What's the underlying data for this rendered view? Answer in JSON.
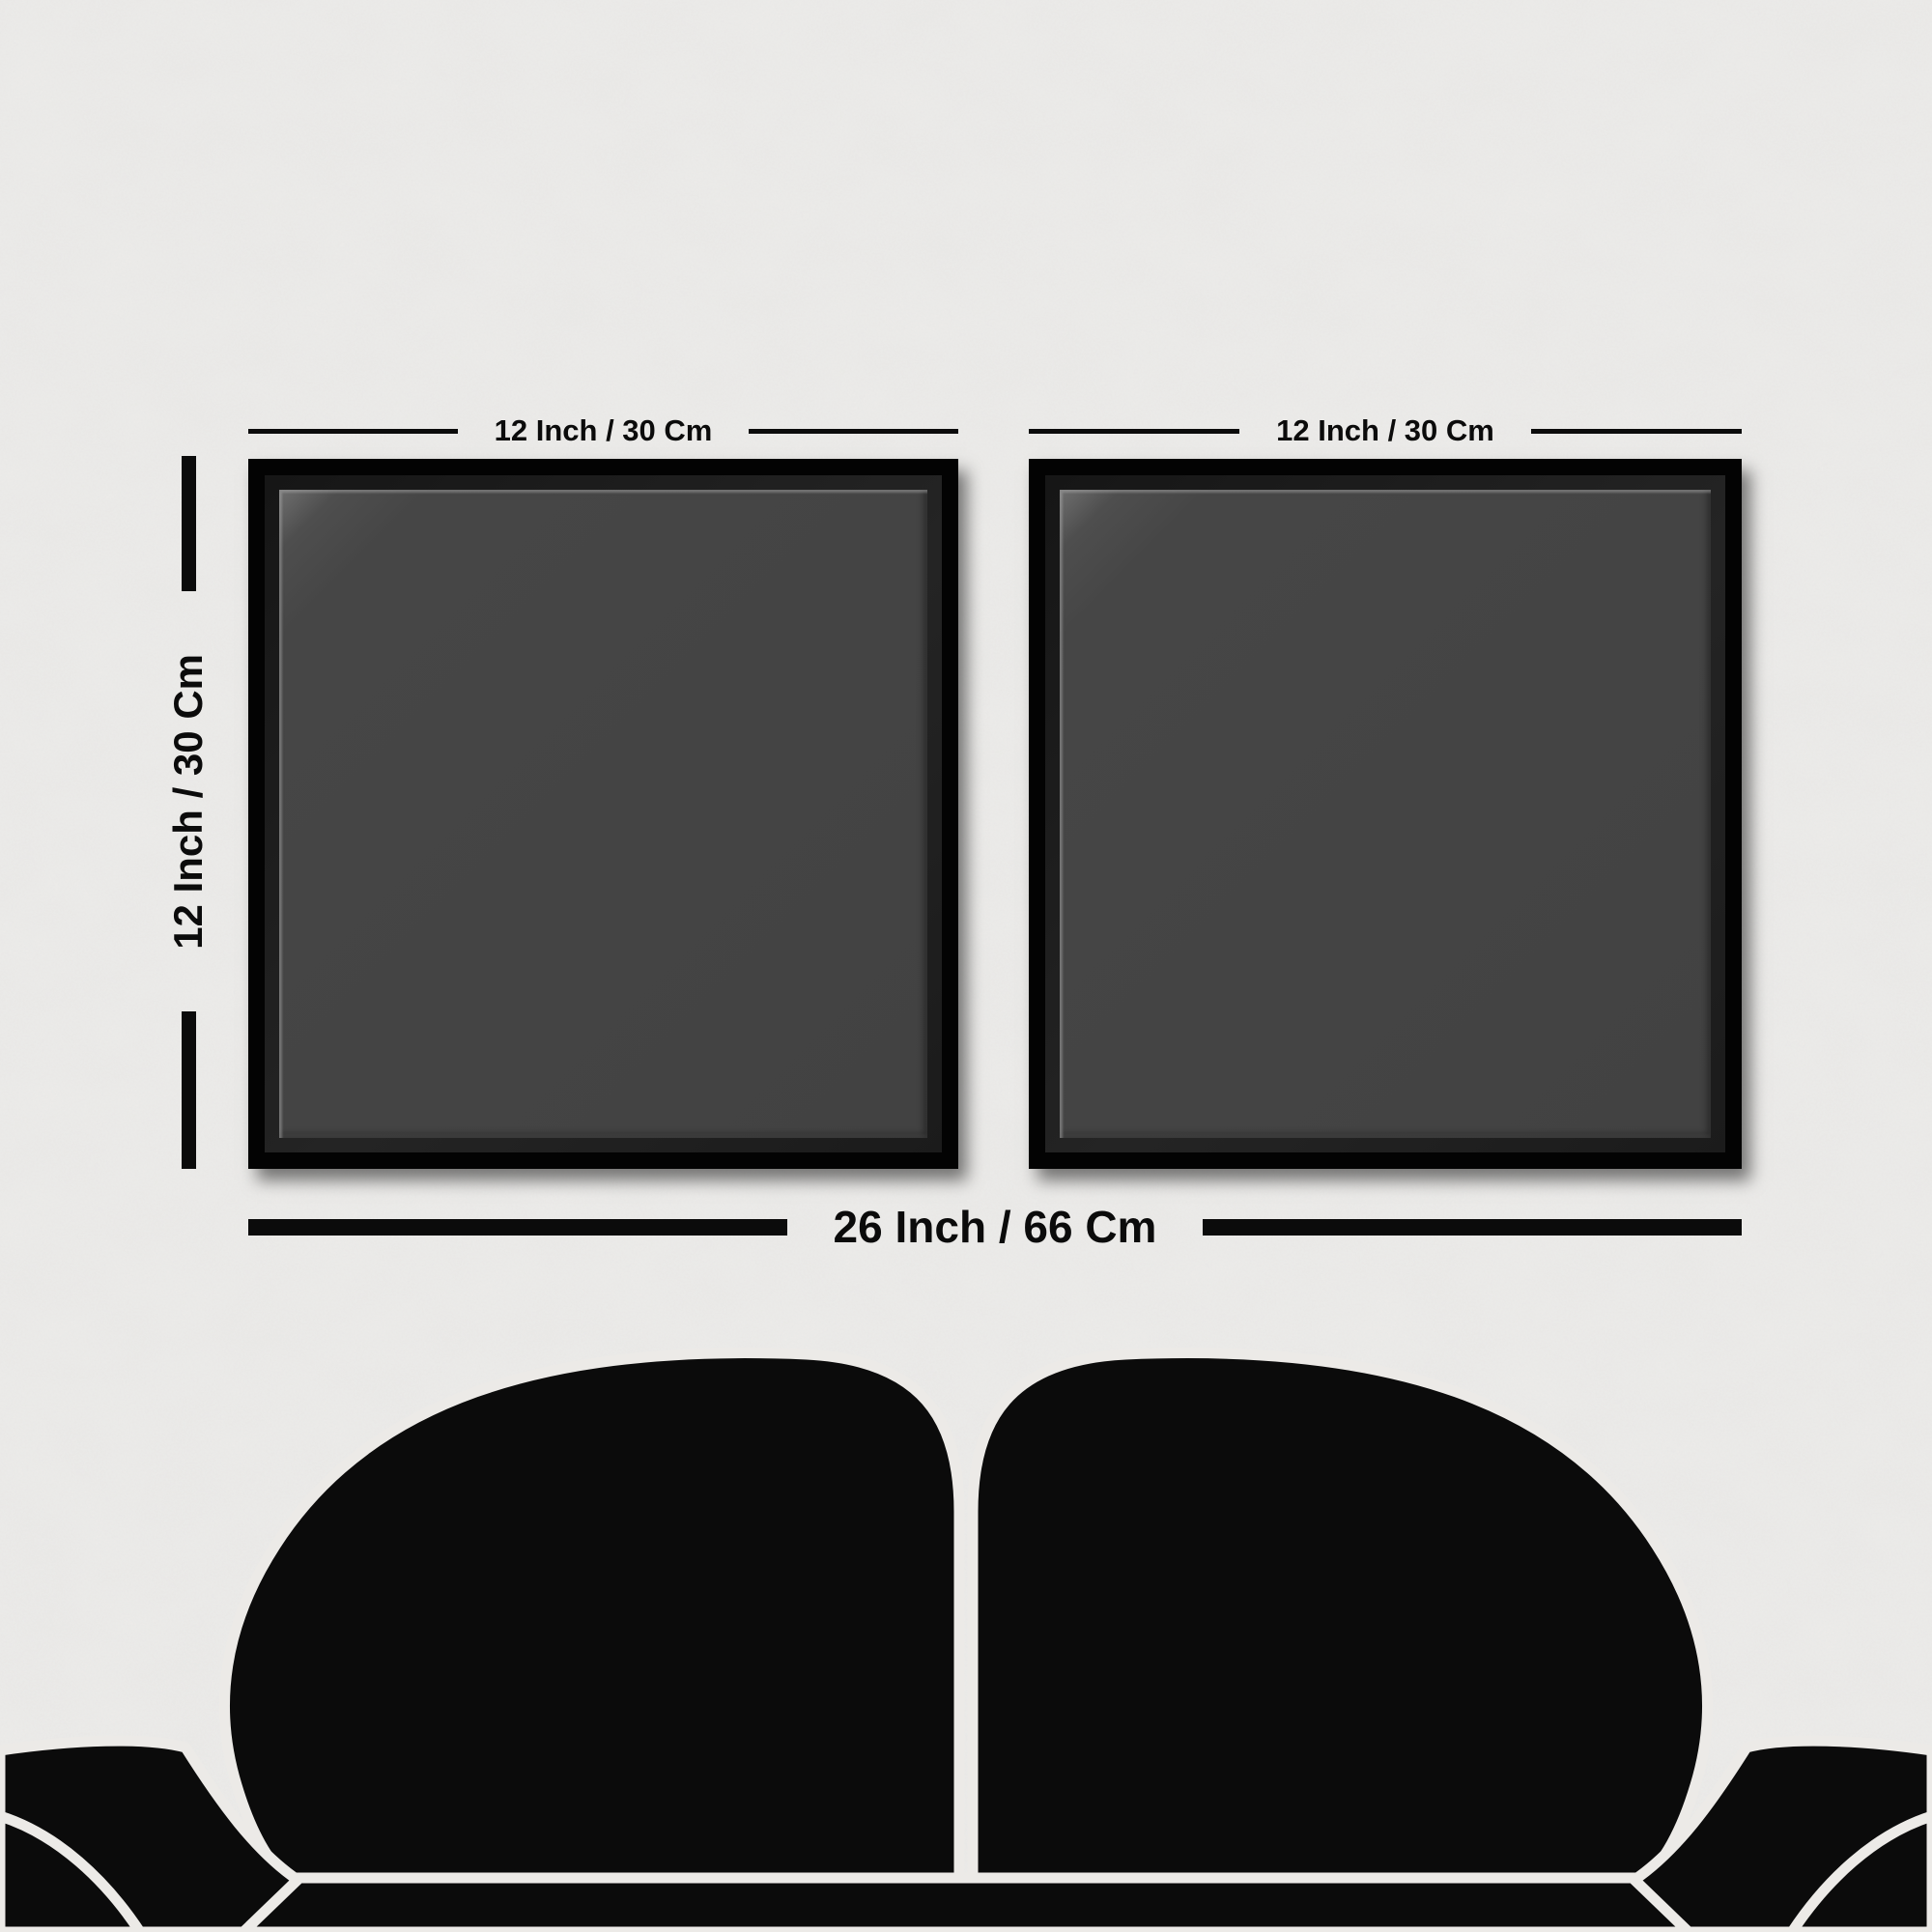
{
  "scene": {
    "type": "wall-art-size-guide-mockup",
    "wall_color": "#edecea",
    "ink_color": "#0b0b0b"
  },
  "frames": {
    "count": 2,
    "border_color": "#030303",
    "mat_color": "#202020",
    "canvas_color": "#454545",
    "items": [
      {
        "id": "left-frame",
        "width_label": "12 Inch / 30 Cm"
      },
      {
        "id": "right-frame",
        "width_label": "12 Inch / 30 Cm"
      }
    ]
  },
  "dimensions": {
    "height_label": "12 Inch / 30 Cm",
    "total_width_label": "26 Inch / 66 Cm"
  },
  "sofa": {
    "kind": "sofa-silhouette",
    "fill_color": "#0b0b0b",
    "outline_color": "#eceae7"
  }
}
